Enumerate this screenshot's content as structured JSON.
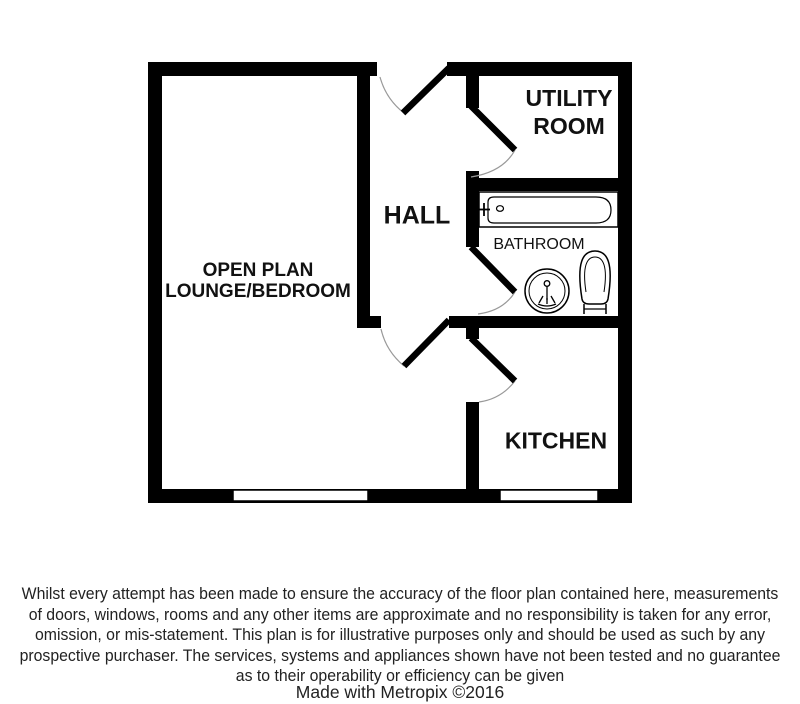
{
  "floorplan": {
    "rooms": {
      "lounge": {
        "lines": [
          "OPEN PLAN",
          "LOUNGE/BEDROOM"
        ]
      },
      "hall": {
        "label": "HALL"
      },
      "utility": {
        "lines": [
          "UTILITY",
          "ROOM"
        ]
      },
      "bathroom": {
        "label": "BATHROOM"
      },
      "kitchen": {
        "label": "KITCHEN"
      }
    },
    "fixtures": [
      "bathtub",
      "sink",
      "toilet"
    ],
    "colors": {
      "wall": "#000000",
      "door_arc": "#999999",
      "background": "#ffffff",
      "text": "#111111"
    }
  },
  "disclaimer": {
    "lines": [
      "Whilst every attempt has been made to ensure the accuracy of the floor plan contained here, measurements",
      "of doors, windows, rooms and any other items are approximate and no responsibility is taken for any error,",
      "omission, or mis-statement. This plan is for illustrative purposes only and should be used as such by any",
      "prospective purchaser. The services, systems and appliances shown have not been tested and no guarantee",
      "as to their operability or efficiency can be given"
    ],
    "credit": "Made with Metropix ©2016"
  }
}
